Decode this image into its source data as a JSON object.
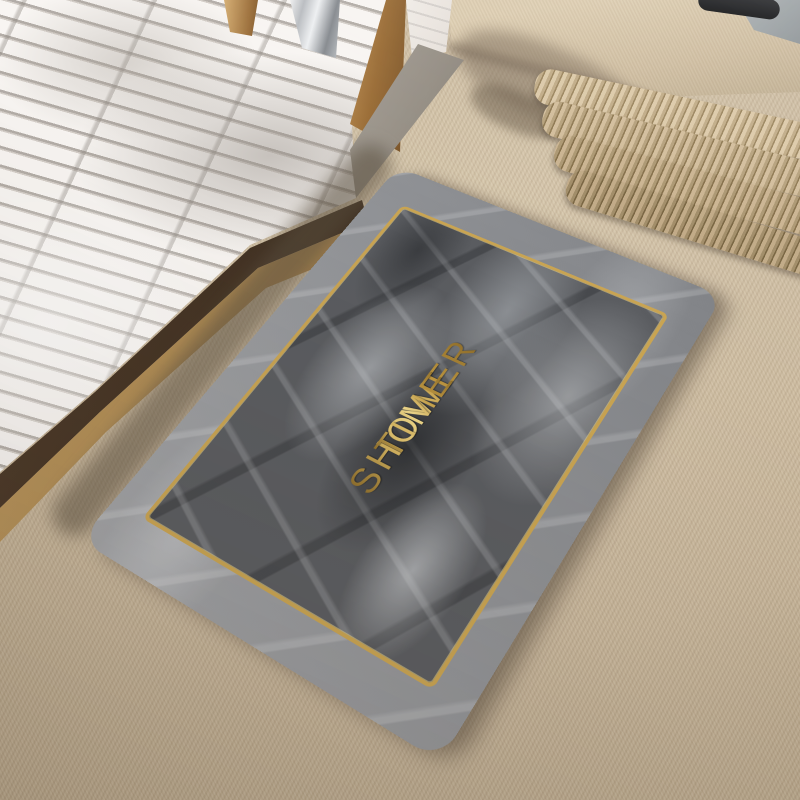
{
  "scene": {
    "description": "Gray marble-pattern bath mat with gold frame border and gold lettering, lying on beige carpet beside a white slatted shower tray; folded towels and a tray with dark slippers sit on a carpeted step at top right",
    "mat": {
      "lines": [
        "SHOWER",
        "TIME"
      ],
      "text_color": "#d4b05a",
      "gold_border_color": "#c9a452",
      "outer_marble_color": "#94969a",
      "inner_marble_color": "#5a5c60"
    },
    "environment": {
      "carpet_color": "#c7b599",
      "shower_slat_color": "#f4f1ee",
      "shower_slat_gap_color": "#b3ada7",
      "door_frame_color": "#9a6c35",
      "curb_color": "#948d83",
      "towel_color": "#c0ab86",
      "tray_color": "#9da4a6",
      "slipper_color": "#1a1b1d"
    },
    "objects": [
      {
        "name": "shower-floor",
        "label": "white slatted shower base"
      },
      {
        "name": "shower-door-frame",
        "label": "wooden shower door frame"
      },
      {
        "name": "shower-curb",
        "label": "stone threshold"
      },
      {
        "name": "bath-mat",
        "label": "marble bath mat with gold border"
      },
      {
        "name": "towel-stack",
        "label": "stack of folded towels"
      },
      {
        "name": "storage-tray",
        "label": "tray with dark slippers"
      }
    ]
  }
}
